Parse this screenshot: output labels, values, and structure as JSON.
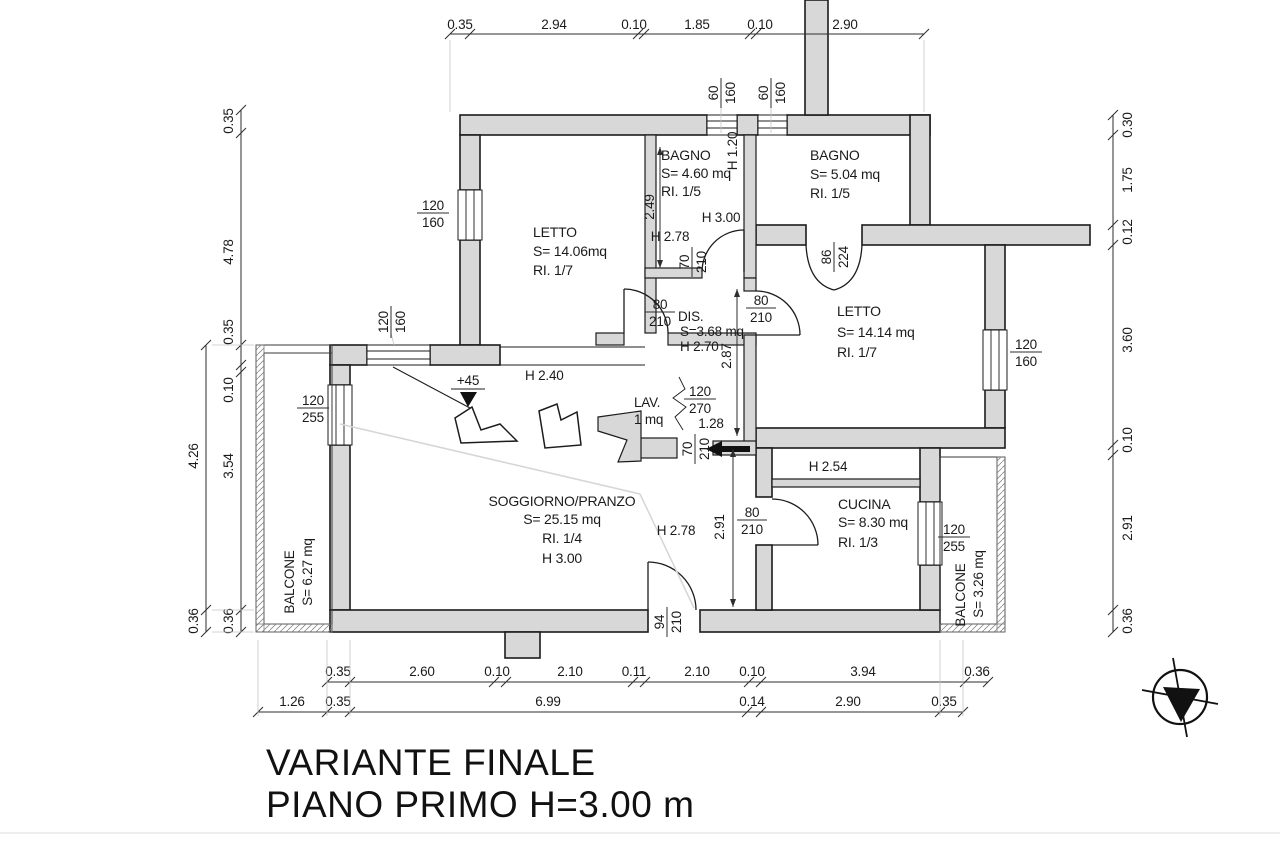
{
  "title": {
    "line1": "VARIANTE FINALE",
    "line2": "PIANO PRIMO H=3.00 m"
  },
  "rooms": {
    "letto1": {
      "name": "LETTO",
      "area": "S= 14.06mq",
      "ri": "RI. 1/7"
    },
    "bagno1": {
      "name": "BAGNO",
      "area": "S= 4.60 mq",
      "ri": "RI. 1/5"
    },
    "bagno2": {
      "name": "BAGNO",
      "area": "S= 5.04 mq",
      "ri": "RI. 1/5"
    },
    "letto2": {
      "name": "LETTO",
      "area": "S= 14.14 mq",
      "ri": "RI. 1/7"
    },
    "dis": {
      "name": "DIS.",
      "area": "S=3.68 mq",
      "h": "H 2.70"
    },
    "lav": {
      "name": "LAV.",
      "area": "1 mq"
    },
    "soggiorno": {
      "name": "SOGGIORNO/PRANZO",
      "area": "S= 25.15 mq",
      "ri": "RI. 1/4",
      "h": "H 3.00"
    },
    "cucina": {
      "name": "CUCINA",
      "area": "S= 8.30 mq",
      "ri": "RI. 1/3"
    },
    "balcone1": {
      "name": "BALCONE",
      "area": "S= 6.27 mq"
    },
    "balcone2": {
      "name": "BALCONE",
      "area": "S= 3.26 mq"
    }
  },
  "heights": {
    "bagni_zone": "H 3.00",
    "bagno1_front": "H 2.78",
    "low_wall": "H 1.20",
    "passage": "H 2.40",
    "sogg_right": "H 2.78",
    "cucina_strip": "H 2.54",
    "level_mark": "+45"
  },
  "vdims": {
    "bagno1": "2.49",
    "dis_lav": "2.87",
    "sogg_right": "2.91"
  },
  "openings": {
    "win_letto1": {
      "a": "120",
      "b": "160"
    },
    "win_passage": {
      "a": "120",
      "b": "160"
    },
    "win_sogg": {
      "a": "120",
      "b": "255"
    },
    "win_top1": {
      "a": "60",
      "b": "160"
    },
    "win_top2": {
      "a": "60",
      "b": "160"
    },
    "door_bagno1": {
      "a": "70",
      "b": "210"
    },
    "door_dis": {
      "a": "80",
      "b": "210"
    },
    "door_letto2": {
      "a": "80",
      "b": "210"
    },
    "door_bagno2": {
      "a": "86",
      "b": "224"
    },
    "win_letto2": {
      "a": "120",
      "b": "160"
    },
    "open_lav": {
      "a": "120",
      "b": "270",
      "w": "1.28"
    },
    "door_corr": {
      "a": "70",
      "b": "210"
    },
    "door_cucina": {
      "a": "80",
      "b": "210"
    },
    "win_cucina": {
      "a": "120",
      "b": "255"
    },
    "door_entry": {
      "a": "94",
      "b": "210"
    }
  },
  "chains": {
    "top": [
      "0.35",
      "2.94",
      "0.10",
      "1.85",
      "0.10",
      "2.90"
    ],
    "left_inner": [
      "0.35",
      "4.78",
      "0.35",
      "0.10",
      "3.54",
      "0.36"
    ],
    "left_outer": [
      "4.26",
      "0.36"
    ],
    "right": [
      "0.30",
      "1.75",
      "0.12",
      "3.60",
      "0.10",
      "2.91",
      "0.36"
    ],
    "bottom1": [
      "0.35",
      "2.60",
      "0.10",
      "2.10",
      "0.11",
      "2.10",
      "0.10",
      "3.94",
      "0.36"
    ],
    "bottom2": [
      "1.26",
      "0.35",
      "6.99",
      "0.14",
      "2.90",
      "0.35"
    ]
  }
}
